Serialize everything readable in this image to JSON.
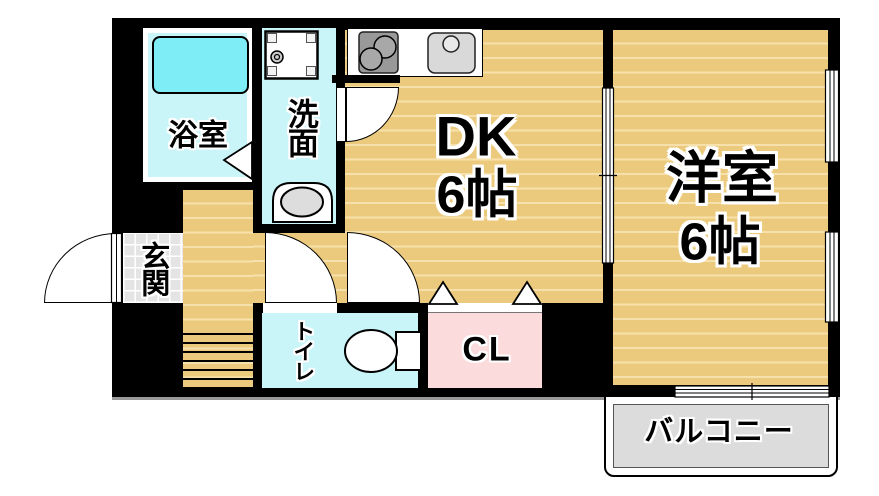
{
  "plan_title": "1DK apartment floor plan",
  "rooms": {
    "bathroom": {
      "label": "浴室"
    },
    "washroom": {
      "label": "洗面"
    },
    "dining_kitchen": {
      "label": "DK",
      "size": "6帖"
    },
    "western_room": {
      "label": "洋室",
      "size": "6帖"
    },
    "entrance": {
      "label": "玄関"
    },
    "toilet": {
      "label": "トイレ"
    },
    "closet": {
      "label": "CL"
    },
    "balcony": {
      "label": "バルコニー"
    }
  },
  "colors": {
    "wall": "#000000",
    "tan": "#ECCA7D",
    "stripe": "#F6E1AC",
    "cyan": "#C9F4F8",
    "tub": "#7EEDF5",
    "pink": "#FBDBDB",
    "balcony": "#DCDCDC",
    "tile": "#E4E4E4"
  }
}
